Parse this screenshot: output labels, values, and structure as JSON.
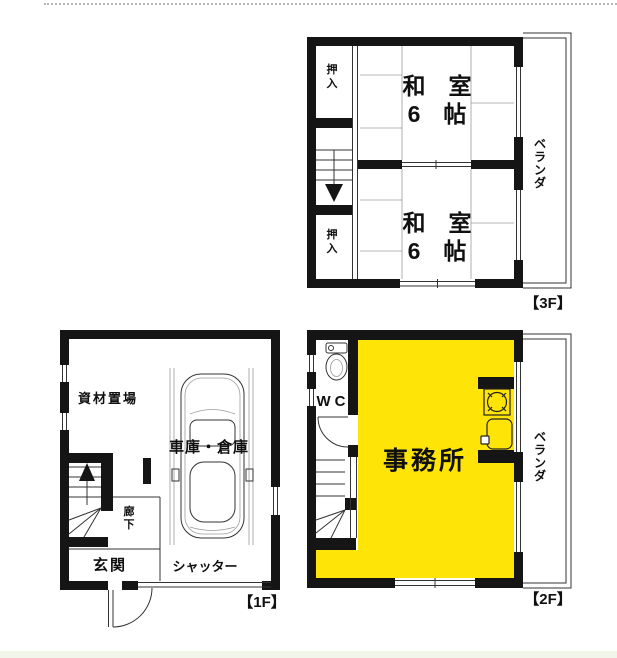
{
  "colors": {
    "wall": "#151515",
    "office_yellow": "#ffe408",
    "line_dark": "#333333",
    "line_light": "#9b9b9b",
    "background": "#ffffff",
    "bottom_strip": "#f2f5e9"
  },
  "floor3": {
    "floor_label": "【3F】",
    "room_upper": {
      "line1": "和　室",
      "line2": "6　帖"
    },
    "room_lower": {
      "line1": "和　室",
      "line2": "6　帖"
    },
    "closet_upper": "押入",
    "closet_lower": "押入",
    "veranda": "ベランダ"
  },
  "floor2": {
    "floor_label": "【2F】",
    "toilet": "WC",
    "office": "事務所",
    "veranda": "ベランダ"
  },
  "floor1": {
    "floor_label": "【1F】",
    "storage": "資材置場",
    "garage": "車庫・倉庫",
    "hallway": "廊下",
    "entrance": "玄関",
    "shutter": "シャッター"
  },
  "icons": {
    "floor1": [
      "car-icon",
      "up-arrow-icon",
      "entrance-door-swing-icon"
    ],
    "floor2": [
      "toilet-icon",
      "gas-stove-icon",
      "kitchen-sink-icon",
      "wc-door-swing-icon"
    ],
    "floor3": [
      "down-arrow-icon"
    ]
  }
}
